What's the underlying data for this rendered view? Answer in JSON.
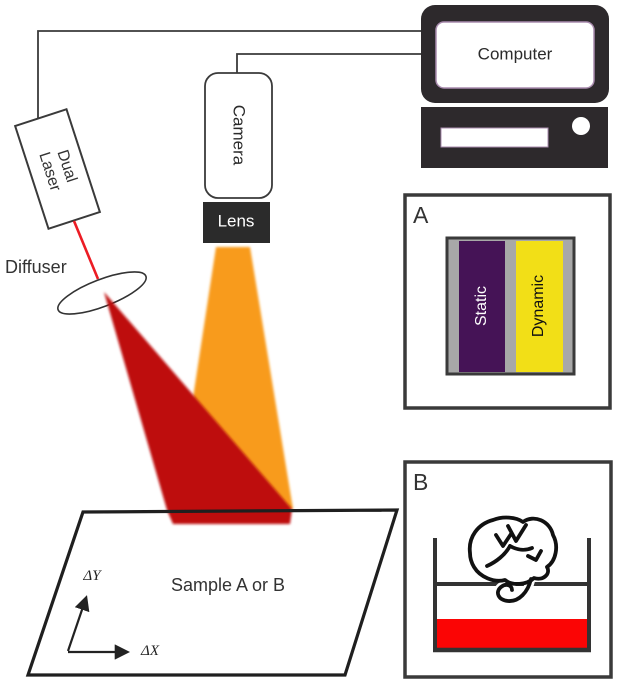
{
  "figure_labels": {
    "computer": "Computer",
    "camera": "Camera",
    "lens": "Lens",
    "dual_laser": [
      "Dual",
      "Laser"
    ],
    "diffuser": "Diffuser",
    "sample": "Sample A or B",
    "axis_y": "ΔY",
    "axis_x": "ΔX"
  },
  "panel_a": {
    "label": "A",
    "regions": {
      "static": "Static",
      "dynamic": "Dynamic"
    }
  },
  "panel_b": {
    "label": "B"
  },
  "colors": {
    "beam_orange": "#F89B1D",
    "beam_red": "#BE1111",
    "laser_red": "#EC1C24",
    "liquid_red": "#FB0505",
    "static_purple": "#451356",
    "dynamic_yellow": "#F2DF17",
    "holder_gray": "#A8A8A8",
    "device_dark": "#2D292C",
    "lens_dark": "#2B2B2B",
    "outline_dark": "#3A3A3A"
  }
}
